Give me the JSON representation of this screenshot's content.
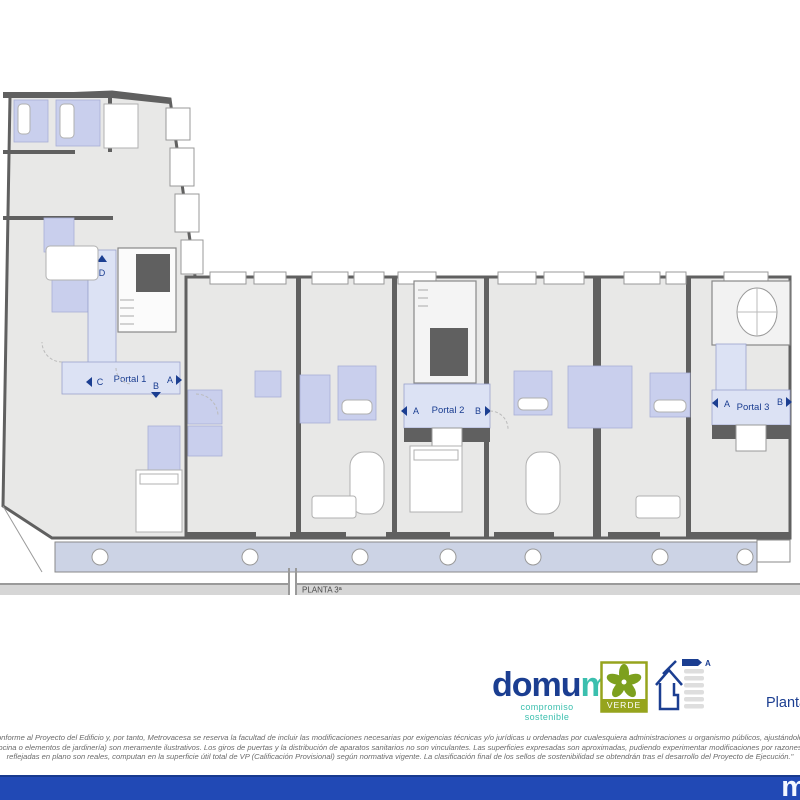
{
  "plan": {
    "floor_band_label": "PLANTA 3ª",
    "unit_d_label": "D",
    "portals": [
      {
        "name": "Portal 1",
        "left_unit": "C",
        "right_unit": "A",
        "down_unit": "B"
      },
      {
        "name": "Portal 2",
        "left_unit": "A",
        "right_unit": "B"
      },
      {
        "name": "Portal 3",
        "left_unit": "A",
        "right_unit": "B"
      }
    ],
    "colors": {
      "wall": "#606060",
      "floor": "#e8e8e7",
      "bathroom": "#c9cfed",
      "portal_corridor": "#dce2f4",
      "balcony": "#ccd3e5",
      "label_navy": "#1b3e91"
    }
  },
  "footer": {
    "brand_main": "domu",
    "brand_accent": "m",
    "brand_tagline": "compromiso sostenible",
    "verde_label": "VERDE",
    "energy_rating": "A",
    "sheet_label": "Planta 3ª",
    "colors": {
      "navy": "#1b3e91",
      "teal": "#3bbfae",
      "green": "#96a41d",
      "bar_blue": "#2149b5"
    }
  },
  "disclaimer": {
    "lines": [
      "sido elaborado conforme al Proyecto del Edificio y, por tanto, Metrovacesa se reserva la facultad de incluir las modificaciones necesarias por exigencias técnicas y/o jurídicas u ordenadas por cualesquiera administraciones u organismo públicos, ajustándolos en todo caso a",
      "en la zona de la cocina o elementos de jardinería) son meramente ilustrativos. Los giros de puertas y la distribución de aparatos sanitarios no son vinculantes. Las superficies expresadas son aproximadas, pudiendo experimentar modificaciones por razones de índole técnica",
      "reflejadas en plano son reales, computan en la superficie útil total de VP (Calificación Provisional) según normativa vigente. La clasificación final de los sellos de sostenibilidad se obtendrán tras el desarrollo del Proyecto de Ejecución.\""
    ]
  },
  "bottom_bar": {
    "letter": "m"
  }
}
